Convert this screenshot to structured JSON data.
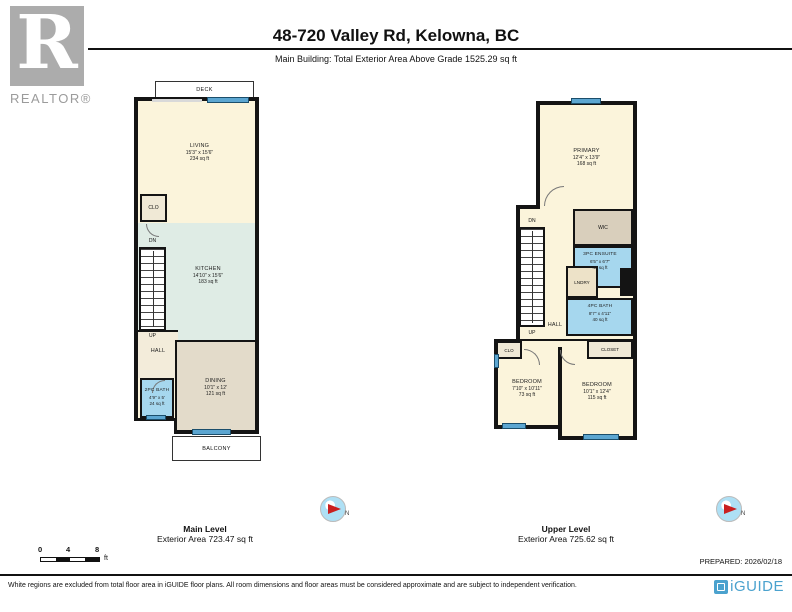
{
  "header": {
    "title": "48-720 Valley Rd, Kelowna, BC",
    "subtitle": "Main Building: Total Exterior Area Above Grade 1525.29 sq ft"
  },
  "branding": {
    "realtor_label": "REALTOR®"
  },
  "main_plan": {
    "caption_title": "Main Level",
    "caption_area": "Exterior Area 723.47 sq ft",
    "deck": "DECK",
    "balcony": "BALCONY",
    "dn": "DN",
    "up": "UP",
    "rooms": {
      "living": {
        "name": "LIVING",
        "dims": "15'3\" x 15'6\"",
        "area": "234 sq ft"
      },
      "clo": {
        "name": "CLO"
      },
      "kitchen": {
        "name": "KITCHEN",
        "dims": "14'10\" x 15'6\"",
        "area": "183 sq ft"
      },
      "hall": {
        "name": "HALL"
      },
      "bath": {
        "name": "2PC BATH",
        "dims": "4'9\" x 5'",
        "area": "24 sq ft"
      },
      "dining": {
        "name": "DINING",
        "dims": "10'1\" x 12'",
        "area": "121 sq ft"
      }
    }
  },
  "upper_plan": {
    "caption_title": "Upper Level",
    "caption_area": "Exterior Area 725.62 sq ft",
    "dn": "DN",
    "up": "UP",
    "rooms": {
      "primary": {
        "name": "PRIMARY",
        "dims": "12'4\" x 13'9\"",
        "area": "168 sq ft"
      },
      "wic": {
        "name": "WIC"
      },
      "ensuite": {
        "name": "3PC ENSUITE",
        "dims": "6'5\" x 6'7\"",
        "area": "40 sq ft"
      },
      "lndry": {
        "name": "LNDRY"
      },
      "bath": {
        "name": "4PC BATH",
        "dims": "8'7\" x 4'11\"",
        "area": "40 sq ft"
      },
      "hall": {
        "name": "HALL"
      },
      "clo": {
        "name": "CLO"
      },
      "closet": {
        "name": "CLOSET"
      },
      "bedroom1": {
        "name": "BEDROOM",
        "dims": "7'10\" x 10'11\"",
        "area": "73 sq ft"
      },
      "bedroom2": {
        "name": "BEDROOM",
        "dims": "10'1\" x 12'4\"",
        "area": "115 sq ft"
      }
    }
  },
  "compass": {
    "label": "N"
  },
  "scalebar": {
    "t0": "0",
    "t4": "4",
    "t8": "8",
    "unit": "ft"
  },
  "footer": {
    "prepared": "PREPARED: 2026/02/18",
    "disclaimer": "White regions are excluded from total floor area in iGUIDE floor plans. All room dimensions and floor areas must be considered approximate and are subject to independent verification.",
    "brand": "iGUIDE"
  },
  "colors": {
    "wall": "#141414",
    "room_cream": "#FBF4DB",
    "room_tan": "#E3DBCA",
    "room_beige": "#F3ECDA",
    "room_bath_blue": "#A6D7EE",
    "room_kitchen_teal": "#DFECE5",
    "window_blue": "#5CA6D1",
    "brand_blue": "#4BA2CE",
    "logo_gray": "#ACACAC"
  }
}
